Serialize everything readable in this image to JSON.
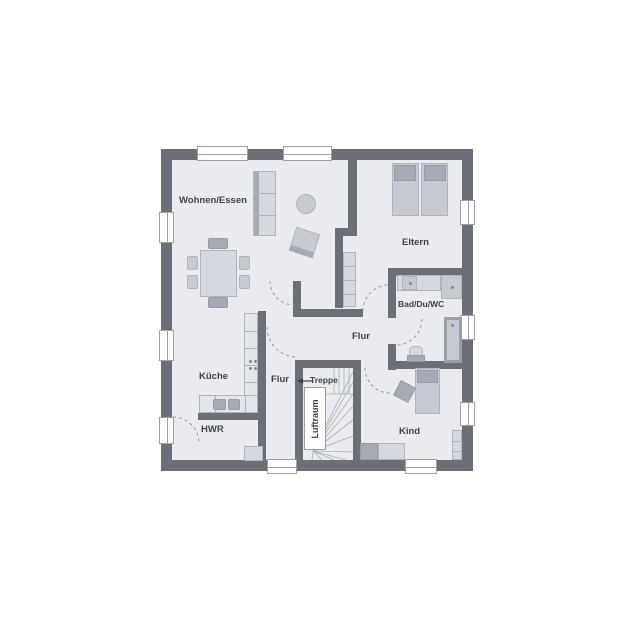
{
  "plan_title": "Obergeschoss Grundriss",
  "rooms": {
    "wohnen_essen": "Wohnen/Essen",
    "eltern": "Eltern",
    "bad": "Bad/Du/WC",
    "flur_main": "Flur",
    "flur_small": "Flur",
    "kueche": "Küche",
    "hwr": "HWR",
    "kind": "Kind"
  },
  "stairs": {
    "treppe": "Treppe",
    "luftraum": "Luftraum"
  },
  "colors": {
    "wall": "#6a6f78",
    "floor": "#e9ebef",
    "background": "#ffffff",
    "furniture_light": "#d5d8de",
    "furniture_medium": "#c6cad2",
    "furniture_dark": "#a5abb5",
    "line": "#9aa0a8",
    "label": "#3e434b",
    "stair_line": "#aab0b8"
  }
}
